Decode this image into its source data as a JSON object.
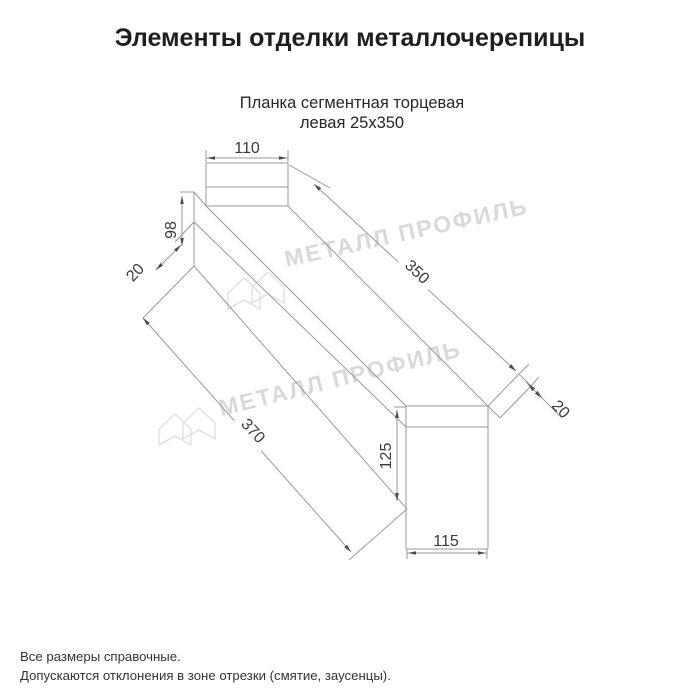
{
  "page": {
    "title": "Элементы отделки металлочерепицы",
    "subtitle_line1": "Планка сегментная торцевая",
    "subtitle_line2": "левая 25х350"
  },
  "drawing": {
    "dim_top_width": "110",
    "dim_left_height": "98",
    "dim_left_fold": "20",
    "dim_length_top": "350",
    "dim_length_bottom": "370",
    "dim_right_fold": "20",
    "dim_right_height": "125",
    "dim_bottom_width": "115"
  },
  "watermark": {
    "text": "МЕТАЛЛ ПРОФИЛЬ"
  },
  "footer": {
    "line1": "Все размеры справочные.",
    "line2": "Допускаются отклонения в зоне отрезки (смятие, заусенцы)."
  },
  "colors": {
    "line": "#9a9a9a",
    "dim_text": "#3a3a3a",
    "watermark": "#d9d9d9",
    "title": "#1d1d22"
  }
}
